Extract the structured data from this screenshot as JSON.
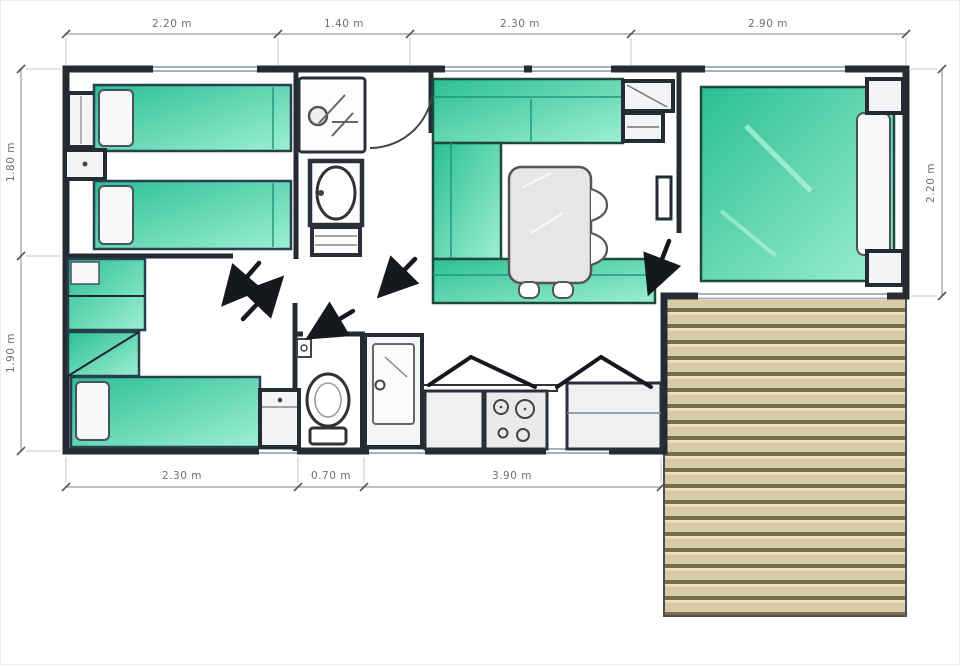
{
  "floorplan": {
    "kind": "mobile-home floor plan with deck",
    "dimensions": {
      "unit": "m",
      "top": [
        "2.20 m",
        "1.40 m",
        "2.30 m",
        "2.90 m"
      ],
      "bottom": [
        "2.30 m",
        "0.70 m",
        "3.90 m"
      ],
      "left": [
        "1.80 m",
        "1.90 m"
      ],
      "right": [
        "2.20 m"
      ]
    },
    "colors": {
      "wall": "#262b33",
      "furniture_green": "#2bbf93",
      "furniture_green_light": "#9defd2",
      "deck_plank": "#d8cba5",
      "deck_highlight": "#eee3c2",
      "deck_gap": "#786d52",
      "dimension_line": "#9a9a9a",
      "dimension_text": "#6f6f6f",
      "background": "#ffffff"
    }
  }
}
